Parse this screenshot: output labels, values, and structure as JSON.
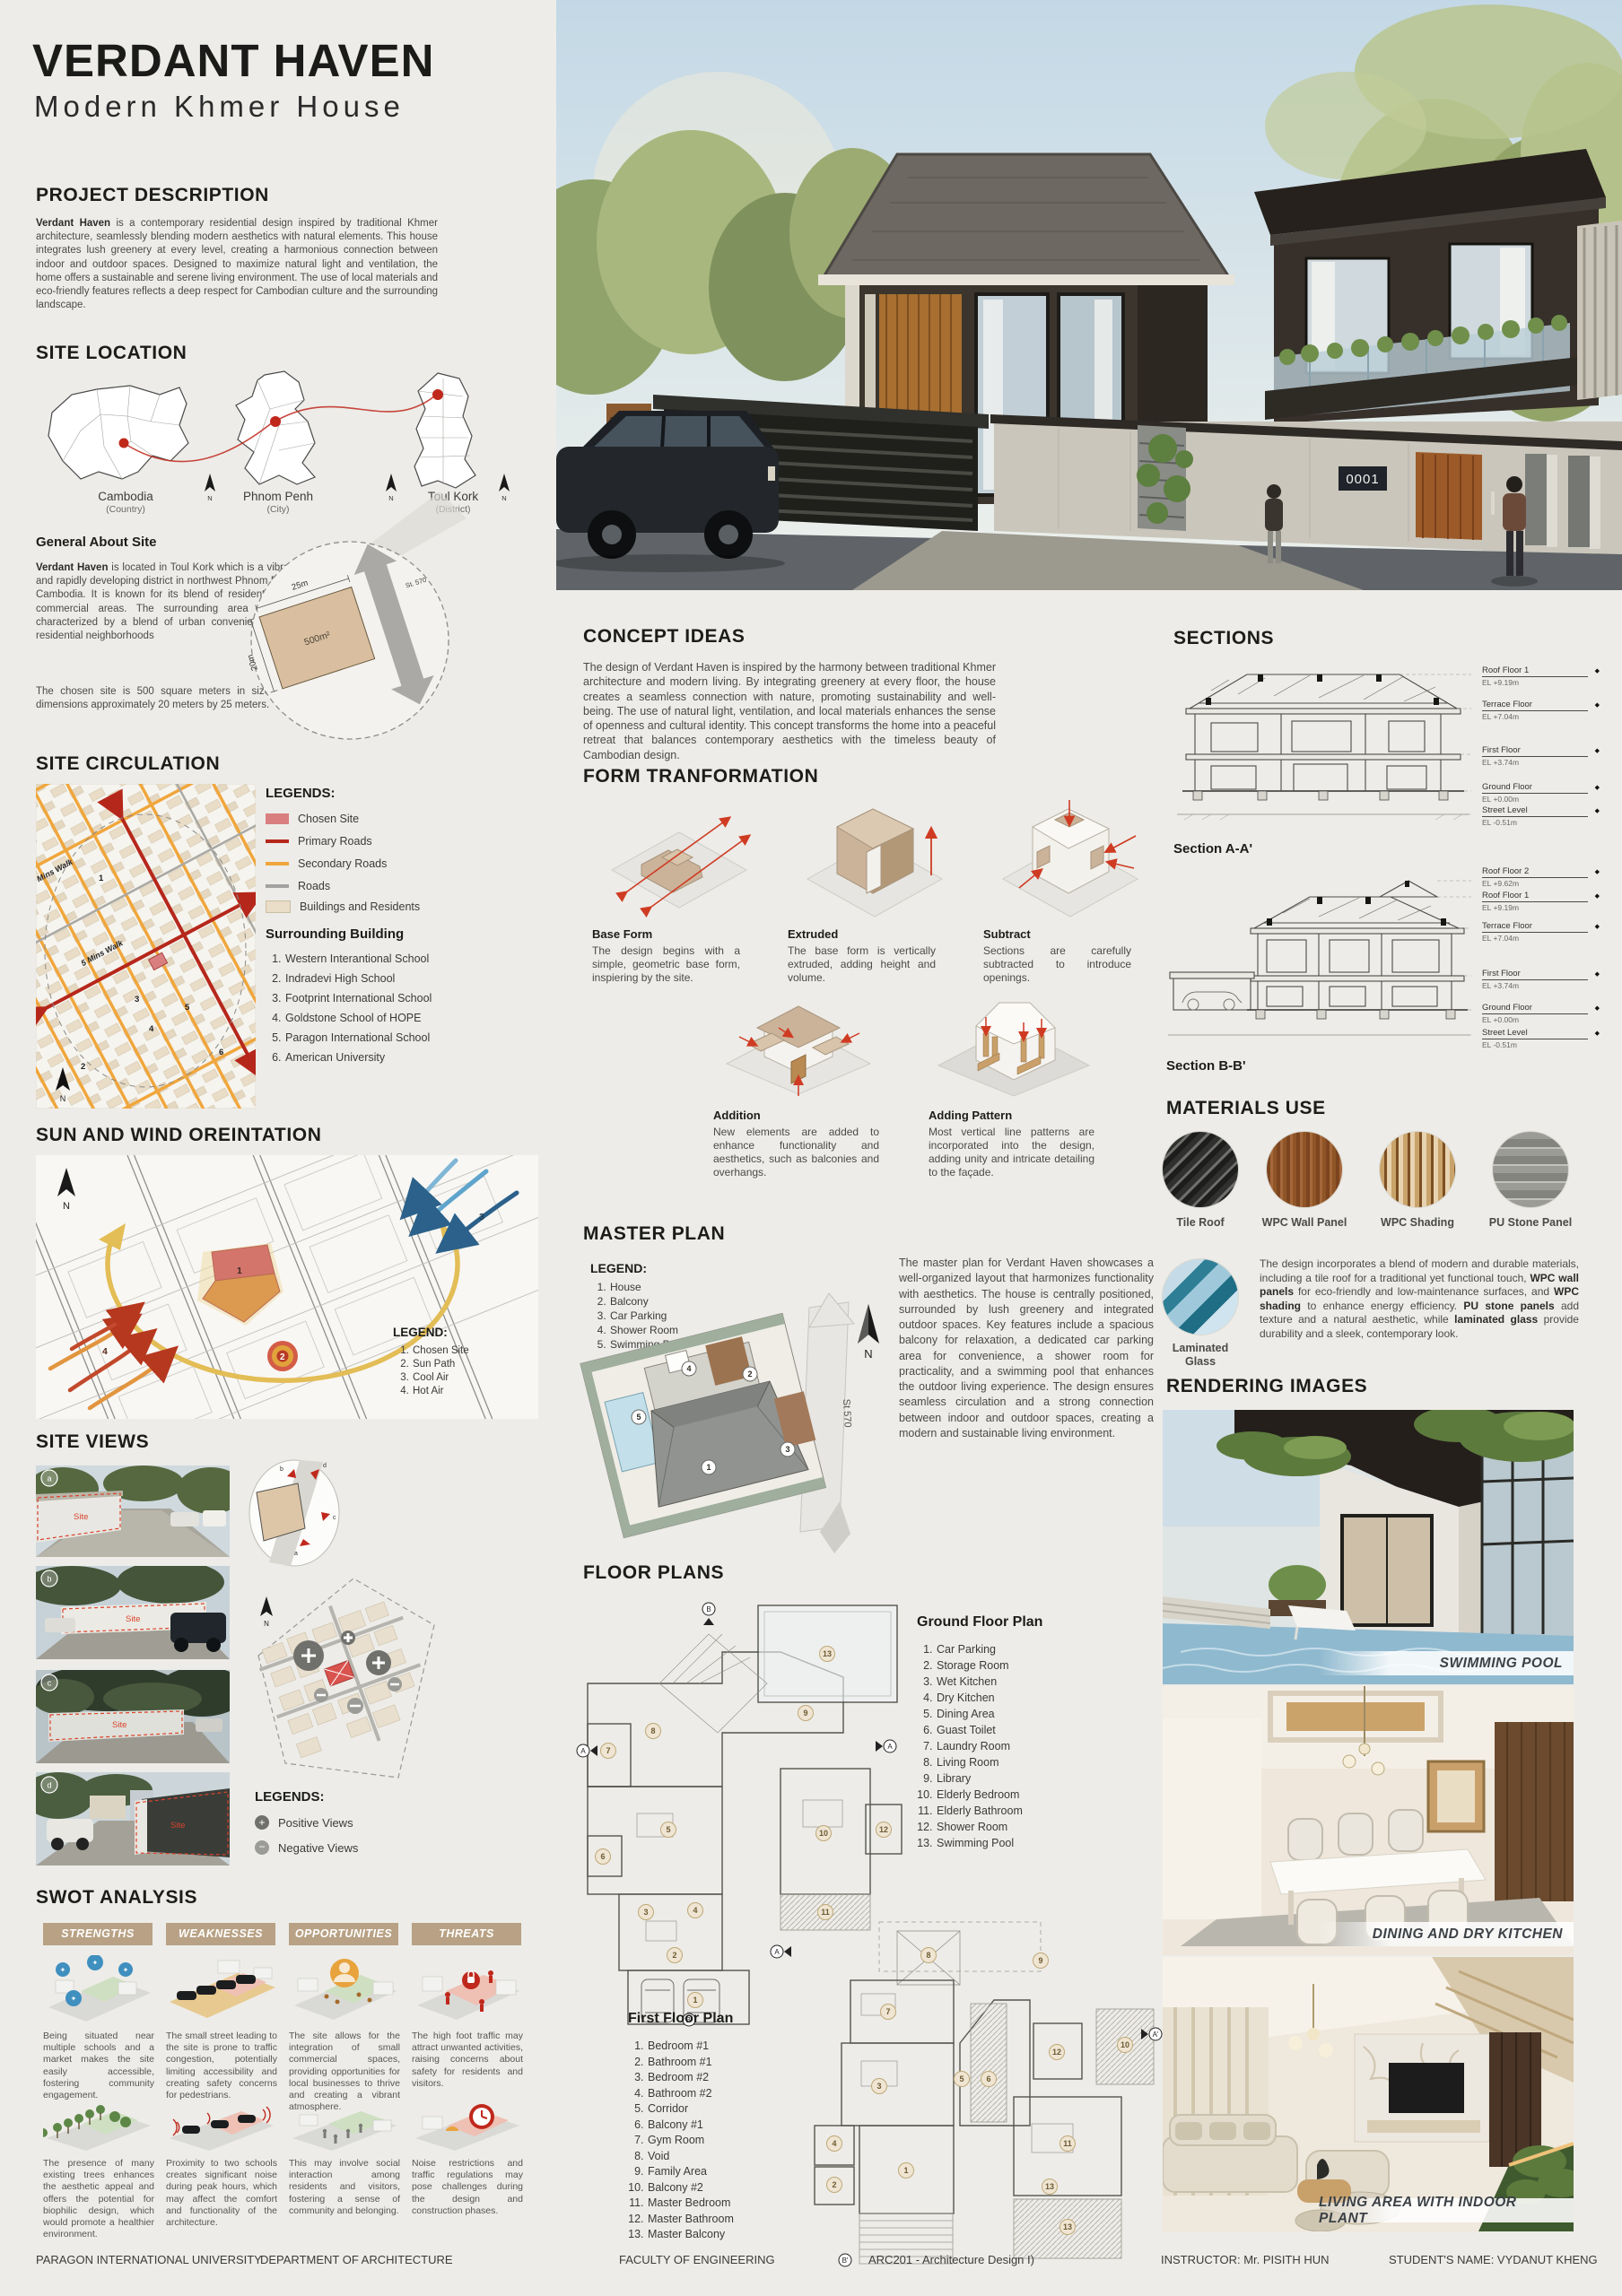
{
  "colors": {
    "paper": "#edece8",
    "accent_red": "#c0281c",
    "secondary_orange": "#f0a63c",
    "tan": "#b8a184",
    "site_pink": "#d97f7f",
    "building_tan": "#e9ddc8"
  },
  "north_label": "N",
  "numbers": [
    "1",
    "2",
    "3",
    "4",
    "5",
    "6",
    "7",
    "8",
    "9",
    "10",
    "11",
    "12",
    "13"
  ],
  "letters": [
    "a",
    "b",
    "c",
    "d"
  ],
  "header": {
    "title": "VERDANT HAVEN",
    "subtitle": "Modern Khmer House"
  },
  "project_description": {
    "heading": "PROJECT DESCRIPTION",
    "body": [
      {
        "t": "Verdant Haven",
        "b": true
      },
      {
        "t": " is a contemporary residential design inspired by traditional Khmer architecture, seamlessly blending modern aesthetics with natural elements. This house integrates lush greenery at every level, creating a harmonious connection between indoor and outdoor spaces. Designed to maximize natural light and ventilation, the home offers a sustainable and serene living environment. The use of local materials and eco-friendly features reflects a deep respect for Cambodian culture and the surrounding landscape."
      }
    ]
  },
  "site_location": {
    "heading": "SITE LOCATION",
    "maps": [
      {
        "name": "Cambodia",
        "type": "(Country)"
      },
      {
        "name": "Phnom Penh",
        "type": "(City)"
      },
      {
        "name": "Toul Kork",
        "type": "(District)"
      }
    ],
    "about": {
      "heading": "General About Site",
      "body1": [
        {
          "t": "Verdant Haven",
          "b": true
        },
        {
          "t": " is located in Toul Kork which is a vibrant and rapidly developing district in northwest Phnom Penh, Cambodia. It is known for its blend of residential and commercial areas. The surrounding area is likely characterized by a blend of urban conveniences and residential neighborhoods"
        }
      ],
      "body2": "The chosen site is 500 square meters in size, with dimensions approximately 20 meters by 25 meters.",
      "dim_width": "25m",
      "dim_depth": "20m",
      "area": "500m²",
      "street": "St. 570"
    }
  },
  "site_circulation": {
    "heading": "SITE CIRCULATION",
    "legend_title": "LEGENDS:",
    "legend": [
      "Chosen Site",
      "Primary Roads",
      "Secondary Roads",
      "Roads",
      "Buildings and Residents"
    ],
    "walk_far": "10 Mins Walk",
    "walk_near": "5 Mins Walk",
    "surrounding_title": "Surrounding Building",
    "surrounding": [
      "Western Interantional School",
      "Indradevi High School",
      "Footprint International School",
      "Goldstone School of HOPE",
      "Paragon International School",
      "American University"
    ]
  },
  "sun_wind": {
    "heading": "SUN AND WIND OREINTATION",
    "legend_title": "LEGEND:",
    "legend": [
      "Chosen Site",
      "Sun Path",
      "Cool Air",
      "Hot Air"
    ]
  },
  "site_views": {
    "heading": "SITE VIEWS",
    "site_label": "Site",
    "legend_title": "LEGENDS:",
    "positive": "Positive Views",
    "negative": "Negative Views"
  },
  "swot": {
    "heading": "SWOT ANALYSIS",
    "columns": [
      {
        "title": "STRENGTHS",
        "top": "Being situated near multiple schools and a market makes the site easily accessible, fostering community engagement.",
        "bottom": "The presence of many existing trees enhances the aesthetic appeal and offers the potential for biophilic design, which would promote a healthier environment."
      },
      {
        "title": "WEAKNESSES",
        "top": "The small street leading to the site is prone to traffic congestion, potentially limiting accessibility and creating safety concerns for pedestrians.",
        "bottom": "Proximity to two schools creates significant noise during peak hours, which may affect the comfort and functionality of the architecture."
      },
      {
        "title": "OPPORTUNITIES",
        "top": "The site allows for the integration of small commercial spaces, providing opportunities for local businesses to thrive and creating a vibrant atmosphere.",
        "bottom": "This may involve social interaction among residents and visitors, fostering a sense of community and belonging."
      },
      {
        "title": "THREATS",
        "top": "The high foot traffic may attract unwanted activities, raising concerns about safety for residents and visitors.",
        "bottom": "Noise restrictions and traffic regulations may pose challenges during the design and construction phases."
      }
    ]
  },
  "concept": {
    "heading": "CONCEPT IDEAS",
    "body": "The design of Verdant Haven is inspired by the harmony between traditional Khmer architecture and modern living. By integrating greenery at every floor, the house creates a seamless connection with nature, promoting sustainability and well-being. The use of natural light, ventilation, and local materials enhances the sense of openness and cultural identity. This concept transforms the home into a peaceful retreat that balances contemporary aesthetics with the timeless beauty of Cambodian design."
  },
  "form_transformation": {
    "heading": "FORM TRANFORMATION",
    "steps": [
      {
        "title": "Base Form",
        "body": "The design begins with a simple, geometric base form, inspiering by the site."
      },
      {
        "title": "Extruded",
        "body": "The base form is vertically extruded, adding height and volume."
      },
      {
        "title": "Subtract",
        "body": "Sections are carefully subtracted to introduce openings."
      },
      {
        "title": "Addition",
        "body": "New elements are added to enhance functionality and aesthetics, such as balconies and overhangs."
      },
      {
        "title": "Adding Pattern",
        "body": "Most vertical line patterns are incorporated into the design, adding unity and intricate detailing to the façade."
      }
    ]
  },
  "master_plan": {
    "heading": "MASTER PLAN",
    "legend_title": "LEGEND:",
    "legend": [
      "House",
      "Balcony",
      "Car Parking",
      "Shower Room",
      "Swimming Pool"
    ],
    "street": "St 570",
    "body": "The master plan for Verdant Haven showcases a well-organized layout that harmonizes functionality with aesthetics. The house is centrally positioned, surrounded by lush greenery and integrated outdoor spaces. Key features include a spacious balcony for relaxation, a dedicated car parking area for convenience, a shower room for practicality, and a swimming pool that enhances the outdoor living experience. The design ensures seamless circulation and a strong connection between indoor and outdoor spaces, creating a modern and sustainable living environment."
  },
  "floor_plans": {
    "heading": "FLOOR PLANS",
    "ground_title": "Ground Floor Plan",
    "ground": [
      "Car Parking",
      "Storage Room",
      "Wet Kitchen",
      "Dry Kitchen",
      "Dining Area",
      "Guast Toilet",
      "Laundry Room",
      "Living Room",
      "Library",
      "Elderly Bedroom",
      "Elderly Bathroom",
      "Shower Room",
      "Swimming Pool"
    ],
    "first_title": "First Floor Plan",
    "first": [
      "Bedroom #1",
      "Bathroom #1",
      "Bedroom #2",
      "Bathroom #2",
      "Corridor",
      "Balcony #1",
      "Gym Room",
      "Void",
      "Family Area",
      "Balcony #2",
      "Master Bedroom",
      "Master Bathroom",
      "Master Balcony"
    ],
    "marker_a": "A",
    "marker_b": "B",
    "marker_a2": "A'",
    "marker_b2": "B'"
  },
  "sections": {
    "heading": "SECTIONS",
    "a_label": "Section A-A'",
    "a_levels": [
      {
        "name": "Roof Floor 1",
        "el": "EL +9.19m"
      },
      {
        "name": "Terrace Floor",
        "el": "EL +7.04m"
      },
      {
        "name": "First Floor",
        "el": "EL +3.74m"
      },
      {
        "name": "Ground Floor",
        "el": "EL +0.00m"
      },
      {
        "name": "Street Level",
        "el": "EL -0.51m"
      }
    ],
    "b_label": "Section B-B'",
    "b_levels": [
      {
        "name": "Roof Floor 2",
        "el": "EL +9.62m"
      },
      {
        "name": "Roof Floor 1",
        "el": "EL +9.19m"
      },
      {
        "name": "Terrace Floor",
        "el": "EL +7.04m"
      },
      {
        "name": "First Floor",
        "el": "EL +3.74m"
      },
      {
        "name": "Ground Floor",
        "el": "EL +0.00m"
      },
      {
        "name": "Street Level",
        "el": "EL -0.51m"
      }
    ]
  },
  "materials": {
    "heading": "MATERIALS USE",
    "items": [
      "Tile Roof",
      "WPC Wall Panel",
      "WPC Shading",
      "PU Stone Panel"
    ],
    "item5_line1": "Laminated",
    "item5_line2": "Glass",
    "body": [
      {
        "t": "The design incorporates a blend of modern and durable materials, including a tile roof for a traditional yet functional touch, "
      },
      {
        "t": "WPC wall panels",
        "b": true
      },
      {
        "t": " for eco-friendly and low-maintenance surfaces, and "
      },
      {
        "t": "WPC shading",
        "b": true
      },
      {
        "t": " to enhance energy efficiency. "
      },
      {
        "t": "PU stone panels",
        "b": true
      },
      {
        "t": " add texture and a natural aesthetic, while "
      },
      {
        "t": "laminated glass",
        "b": true
      },
      {
        "t": " provide durability and a sleek, contemporary look."
      }
    ]
  },
  "renderings": {
    "heading": "RENDERING IMAGES",
    "captions": [
      "SWIMMING POOL",
      "DINING AND DRY KITCHEN",
      "LIVING AREA WITH INDOOR PLANT"
    ]
  },
  "hero": {
    "house_number": "0001"
  },
  "footer": [
    "PARAGON INTERNATIONAL UNIVERSITY",
    "DEPARTMENT OF ARCHITECTURE",
    "FACULTY OF ENGINEERING",
    "ARC201 - Architecture Design I)",
    "INSTRUCTOR: Mr. PISITH HUN",
    "STUDENT'S NAME: VYDANUT KHENG"
  ]
}
